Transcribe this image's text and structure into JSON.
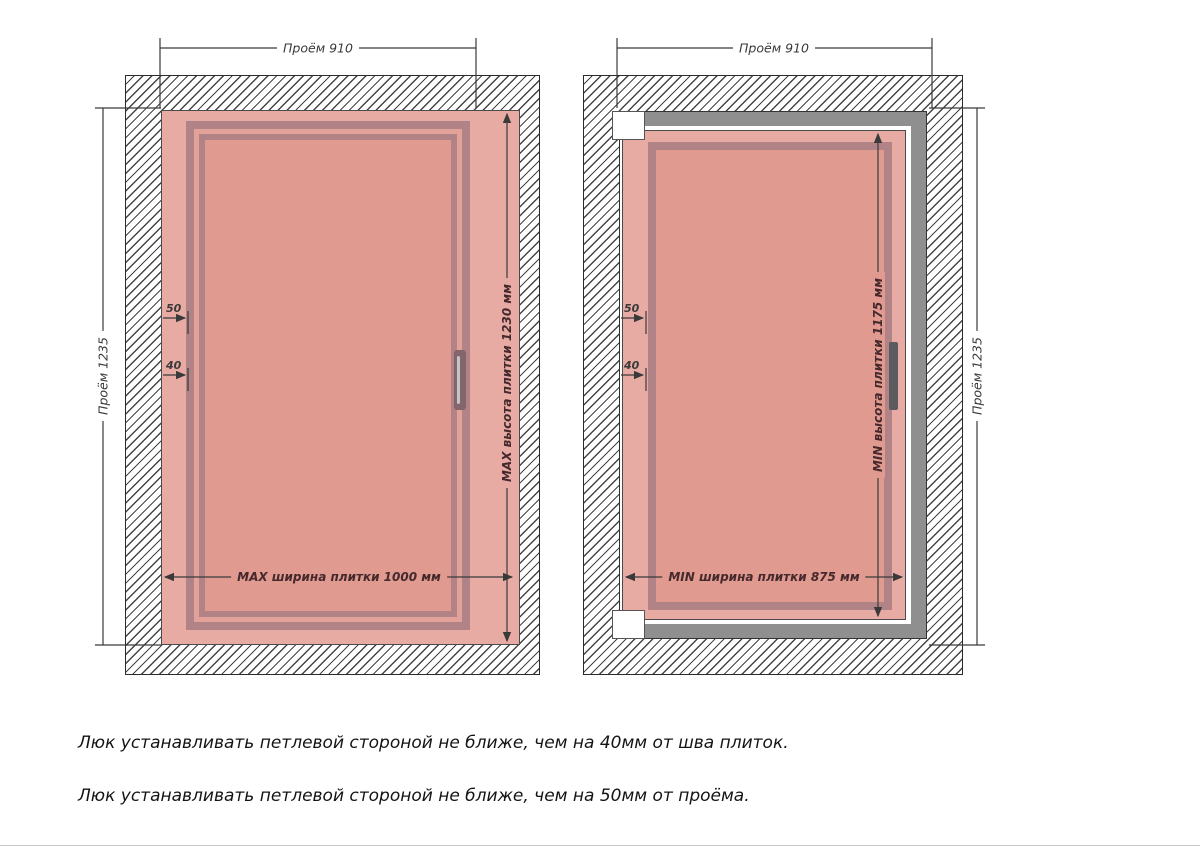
{
  "diagram_max": {
    "opening_width": "Проём 910",
    "opening_height": "Проём 1235",
    "tile_height": "MAX высота плитки 1230 мм",
    "tile_width": "MAX ширина плитки 1000 мм",
    "offset_from_opening": "50",
    "offset_from_seam": "40"
  },
  "diagram_min": {
    "opening_width": "Проём 910",
    "opening_height": "Проём 1235",
    "tile_height": "MIN высота плитки 1175 мм",
    "tile_width": "MIN ширина плитки 875 мм",
    "offset_from_opening": "50",
    "offset_from_seam": "40"
  },
  "notes": {
    "note1": "Люк устанавливать петлевой стороной не ближе, чем на 40мм от шва плиток.",
    "note2": "Люк устанавливать петлевой стороной не ближе, чем на 50мм от проёма."
  },
  "colors": {
    "tile_margin": "#e7aba4",
    "tile_face": "#e09a8f",
    "frame_line": "#b18387",
    "metal_frame": "#8f8f8f",
    "dimension_line": "#3a3a3a",
    "label_maroon": "#45292c"
  }
}
